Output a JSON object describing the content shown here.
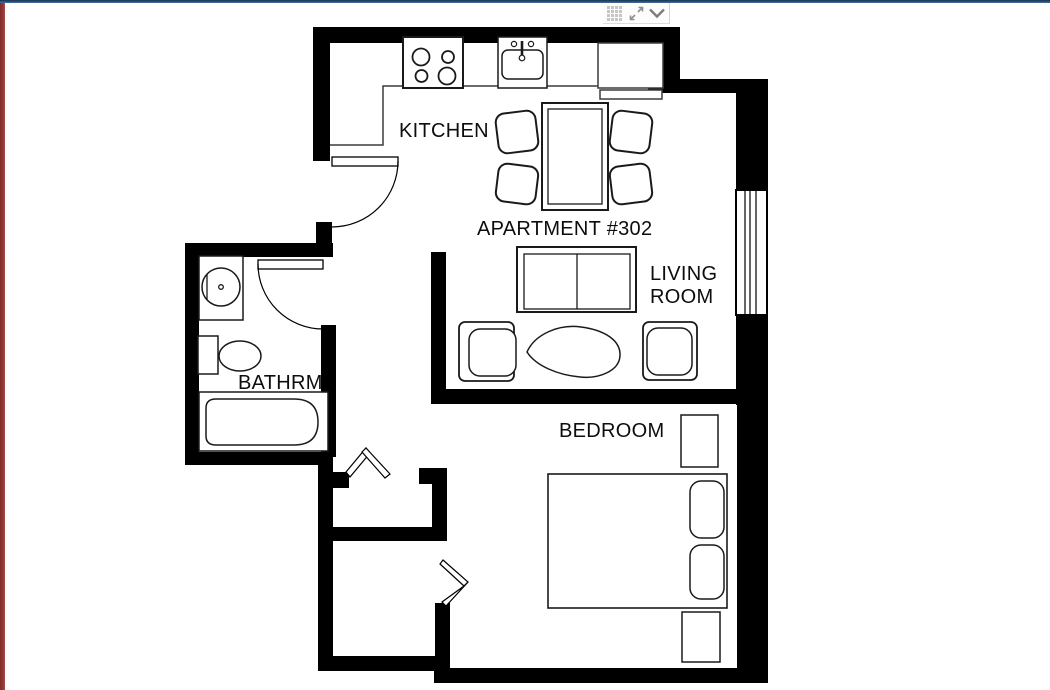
{
  "window": {
    "top_border_color": "#2c527d",
    "left_border_color": "#943634",
    "canvas_background": "#ffffff"
  },
  "toolbar": {
    "icons": [
      {
        "name": "table-grid-icon"
      },
      {
        "name": "expand-icon"
      },
      {
        "name": "chevron-down-icon"
      }
    ]
  },
  "floor_plan": {
    "labels": {
      "apartment": "APARTMENT #302",
      "kitchen": "KITCHEN",
      "living_line1": "LIVING",
      "living_line2": "ROOM",
      "bathroom": "BATHRM",
      "bedroom": "BEDROOM"
    },
    "colors": {
      "wall": "#000000",
      "furniture_line": "#222222",
      "counter_line": "#3c3c3c"
    },
    "furniture_icons": [
      "stove-cooktop-icon",
      "kitchen-sink-icon",
      "kitchen-counter",
      "dining-table-icon",
      "dining-chair-icon",
      "sofa-icon",
      "coffee-table-icon",
      "armchair-icon",
      "wash-basin-icon",
      "toilet-icon",
      "bathtub-icon",
      "double-bed-icon",
      "pillow-icon",
      "nightstand-icon",
      "window-symbol",
      "door-swing-symbol",
      "angled-door-symbol"
    ]
  }
}
